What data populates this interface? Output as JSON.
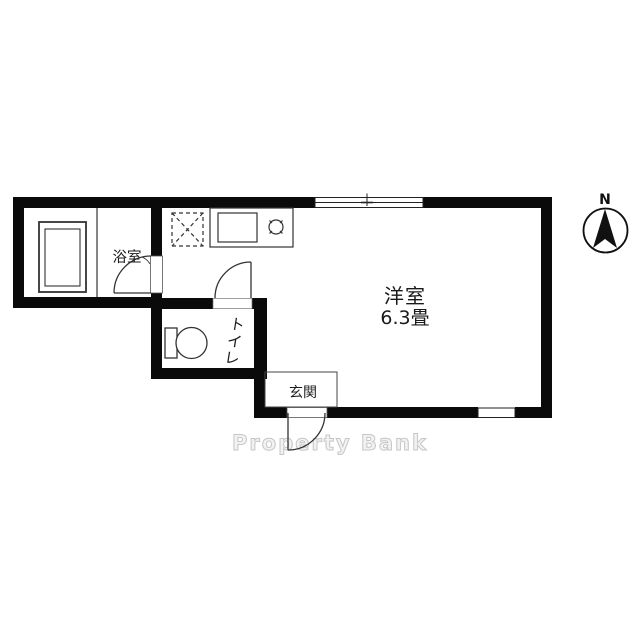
{
  "meta": {
    "drawing_type": "floor-plan",
    "orientation_marker": "north-up"
  },
  "colors": {
    "background": "#ffffff",
    "wall": "#0a0a0a",
    "line": "#333333",
    "thin_line": "#444444",
    "text": "#1a1a1a",
    "watermark_stroke": "#c6c6c6",
    "watermark_fill": "#f2f2f2"
  },
  "rooms": {
    "bathroom": {
      "label": "浴室"
    },
    "toilet": {
      "label": "トイレ",
      "chars": [
        "ト",
        "イ",
        "レ"
      ]
    },
    "entrance": {
      "label": "玄関"
    },
    "main_room": {
      "label": "洋室",
      "size": "6.3畳"
    }
  },
  "compass": {
    "label": "N"
  },
  "watermark": {
    "text": "Property Bank"
  }
}
